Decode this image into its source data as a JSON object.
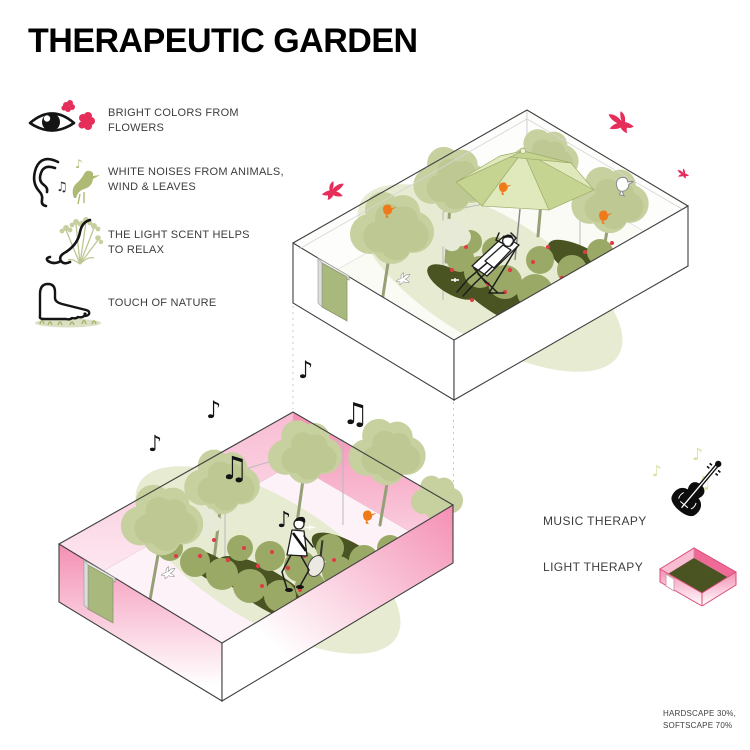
{
  "title": "THERAPEUTIC GARDEN",
  "legend": {
    "items": [
      {
        "icon": "eye-flowers-icon",
        "line1": "BRIGHT COLORS FROM",
        "line2": "FLOWERS"
      },
      {
        "icon": "ear-bird-icon",
        "line1": "WHITE NOISES FROM ANIMALS,",
        "line2": "WIND & LEAVES"
      },
      {
        "icon": "nose-plant-icon",
        "line1": "THE LIGHT SCENT HELPS",
        "line2": "TO RELAX"
      },
      {
        "icon": "foot-grass-icon",
        "line1": "TOUCH OF NATURE",
        "line2": ""
      }
    ]
  },
  "therapies": [
    {
      "icon": "violin-icon",
      "label": "MUSIC THERAPY"
    },
    {
      "icon": "light-box-icon",
      "label": "LIGHT THERAPY"
    }
  ],
  "footnote": {
    "line1": "HARDSCAPE 30%,",
    "line2": "SOFTSCAPE 70%"
  },
  "icons": {
    "note_single": "♪",
    "note_double": "♫"
  },
  "colors": {
    "accentPink": "#e62e5b",
    "orangeBird": "#ef7a1a",
    "treeGreen": "#c7d09f",
    "treeGreenDark": "#b2bf86",
    "treePale": "#e6ead6",
    "bushGreen": "#9aaa66",
    "groundOlive": "#4a5422",
    "umbGreen": "#c5d591",
    "umbGreenLight": "#e0e9bc",
    "wallPink": "#f48fb4",
    "wallPinkLight": "#fbd3e2",
    "noteOlive": "#d8e0a0",
    "doorGreen": "#a9b87c",
    "outline": "#3f3f3f",
    "textColor": "#3d3d3d"
  }
}
